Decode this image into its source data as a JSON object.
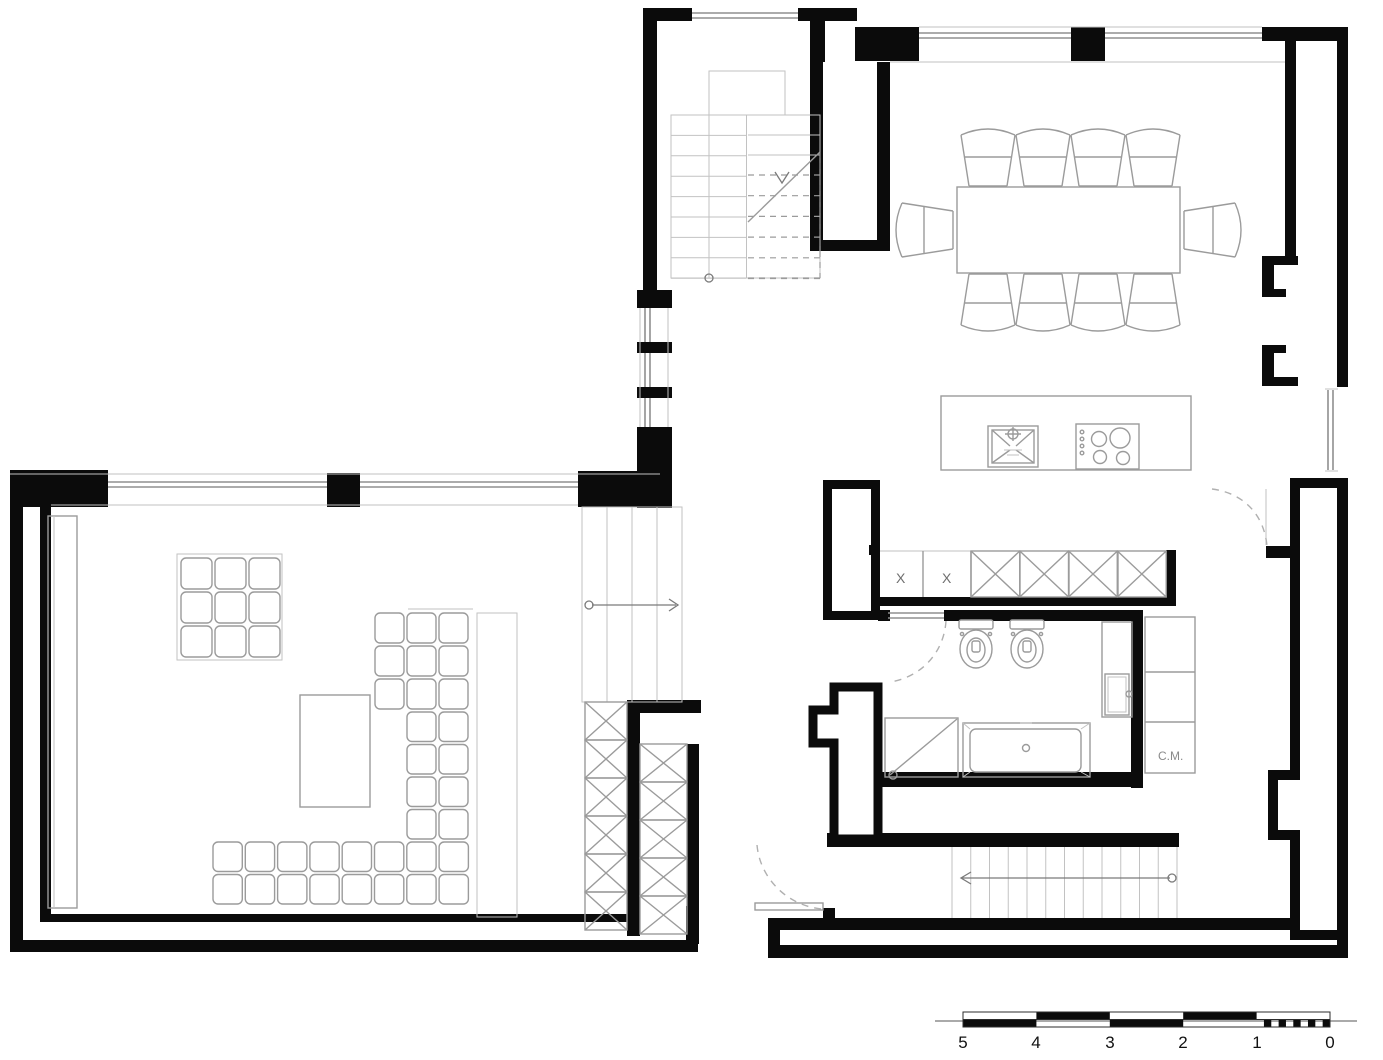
{
  "plan": {
    "labels": {
      "cabinet_x1": "X",
      "cabinet_x2": "X",
      "cm": "C.M."
    },
    "scale_bar": {
      "ticks": [
        "5",
        "4",
        "3",
        "2",
        "1",
        "0"
      ]
    },
    "colors": {
      "wall": "#0b0b0b",
      "furniture_line": "#9b9b9b",
      "window_line": "#8f8f8f",
      "dashed_line": "#b0b0b0",
      "background": "#ffffff",
      "scale_black": "#0b0b0b"
    }
  }
}
